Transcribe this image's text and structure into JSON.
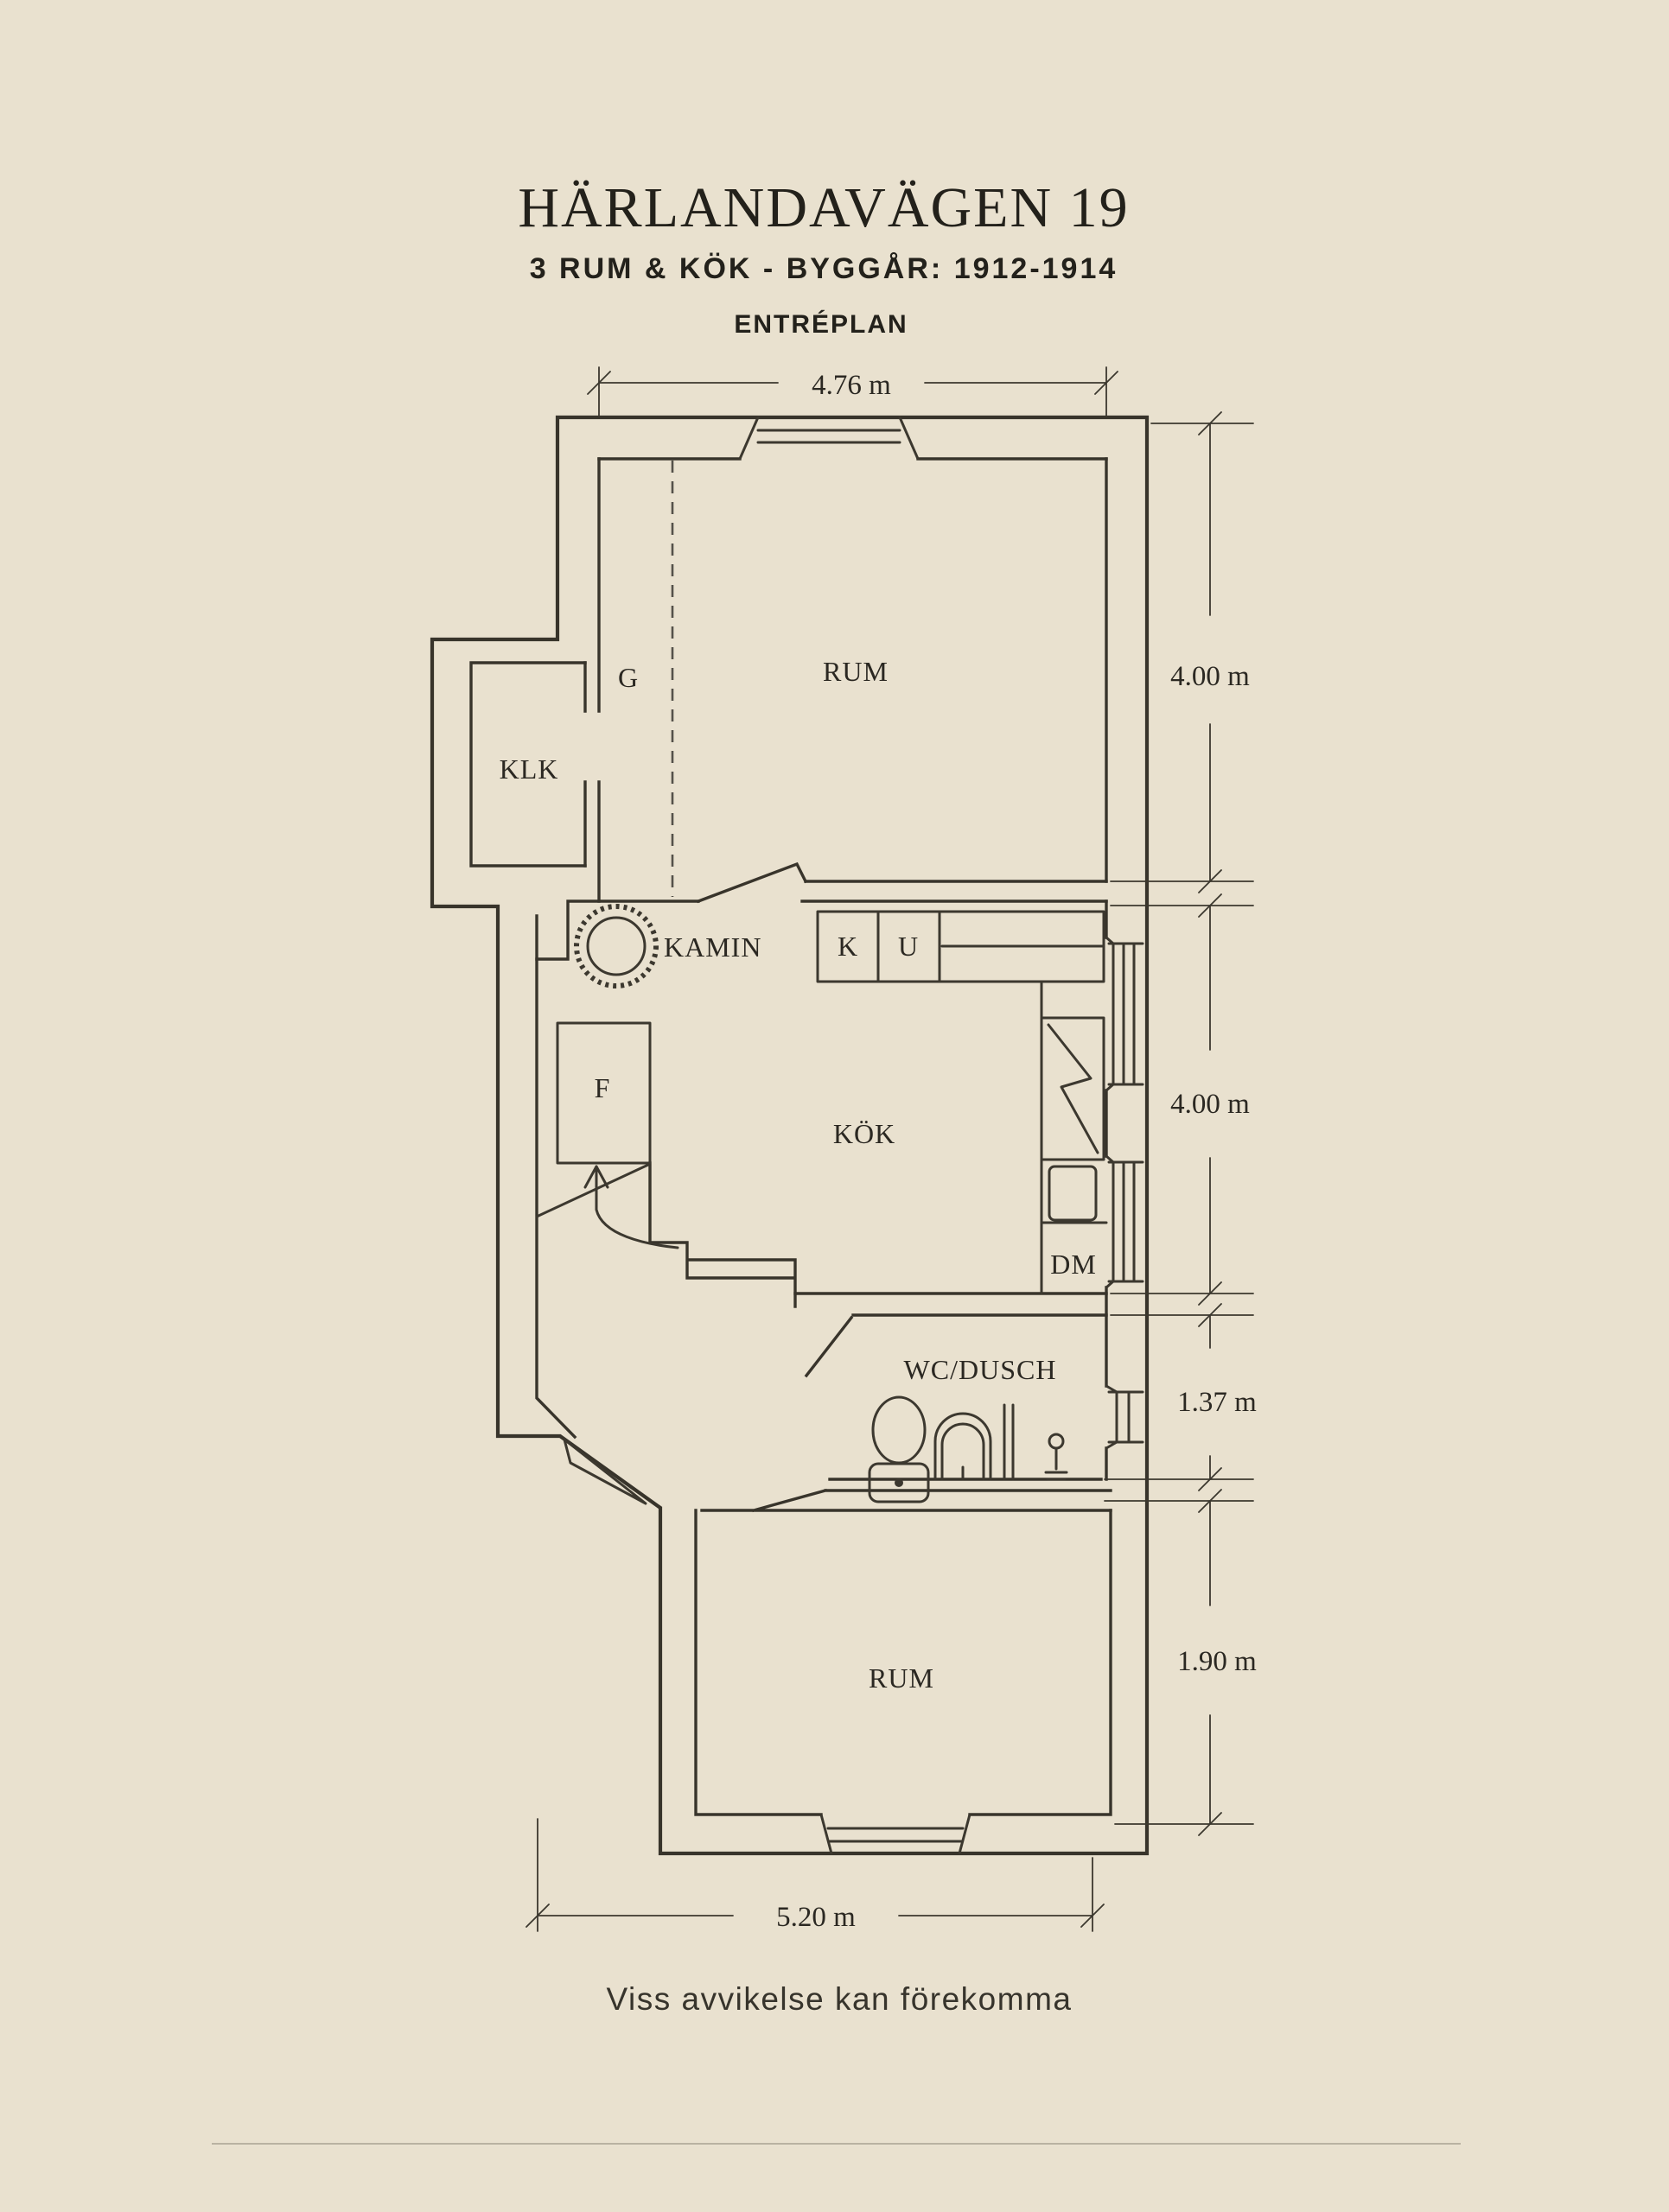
{
  "header": {
    "title": "HÄRLANDAVÄGEN 19",
    "subtitle": "3 RUM & KÖK  -  BYGGÅR: 1912-1914",
    "plan_label": "ENTRÉPLAN"
  },
  "floor_plan": {
    "rooms": {
      "rum_upper": "RUM",
      "klk": "KLK",
      "garderob": "G",
      "kamin": "KAMIN",
      "kok": "KÖK",
      "skap_k": "K",
      "skap_u": "U",
      "forrad_f": "F",
      "diskmaskin": "DM",
      "wc_dusch": "WC/DUSCH",
      "rum_lower": "RUM"
    },
    "dimensions": {
      "top_width": "4.76 m",
      "upper_room_height": "4.00 m",
      "kitchen_height": "4.00 m",
      "wc_height": "1.37 m",
      "lower_room_height": "1.90 m",
      "bottom_width": "5.20 m"
    }
  },
  "footer": {
    "disclaimer": "Viss avvikelse kan förekomma"
  },
  "colors": {
    "background": "#e9e1cf",
    "ink": "#38342b"
  }
}
